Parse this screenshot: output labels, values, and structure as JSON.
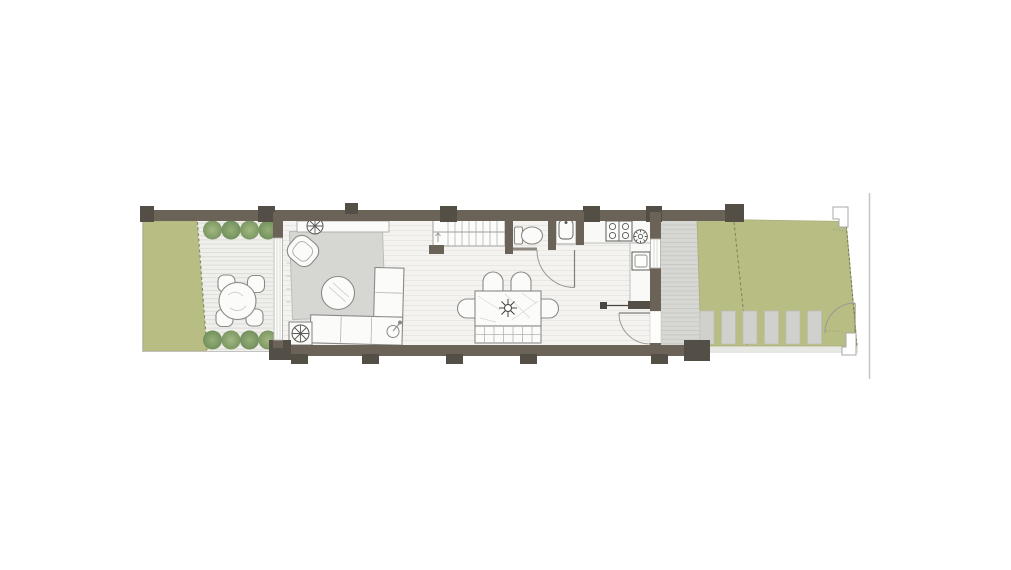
{
  "canvas": {
    "width": 1011,
    "height": 570,
    "background": "#ffffff"
  },
  "colors": {
    "wall": "#6b6357",
    "wall_dark": "#534e46",
    "lawn": "#b7bd83",
    "lawn_edge": "#a9ae7c",
    "deck_bg": "#efefec",
    "deck_line": "#deddd8",
    "floor_bg": "#f4f3f0",
    "floor_line": "#e8e7e3",
    "patio_bg": "#d7d7d3",
    "patio_line": "#c9c9c5",
    "paver": "#d0d1cd",
    "rug": "#d6d7d3",
    "furniture_fill": "#fbfbfa",
    "furniture_outline": "#8a8a86",
    "fixture_outline": "#5a5a55",
    "shrub_dark": "#7c9764",
    "shrub_light": "#9fb47e",
    "dash_olive": "#7d8455",
    "boundary": "#c6c6c3",
    "glass": "#fdfdfc",
    "door_arc": "#9a9a96"
  },
  "features": {
    "left_garden": {
      "shrubs": 8,
      "terrace_table": 1,
      "terrace_chairs": 4,
      "deck_boards": true
    },
    "house": {
      "areas": [
        "living-area",
        "staircase",
        "wc",
        "washbasin-closet",
        "kitchen",
        "dining-area"
      ],
      "furniture": [
        "console",
        "armchair",
        "coffee-table",
        "corner-sofa",
        "floor-lamp",
        "potted-plant",
        "side-table-plant",
        "dining-table",
        "dining-chairs",
        "bench",
        "toilet",
        "washbasin",
        "hob-4-burner",
        "round-sink",
        "oven"
      ],
      "doors": [
        "hall-door",
        "rear-garden-door"
      ],
      "windows": [
        "left-facade-glazing",
        "kitchen-window"
      ]
    },
    "right_garden": {
      "stepping_stones": 6,
      "gate_posts": 2,
      "gate": 1,
      "paved_strip": true
    }
  }
}
